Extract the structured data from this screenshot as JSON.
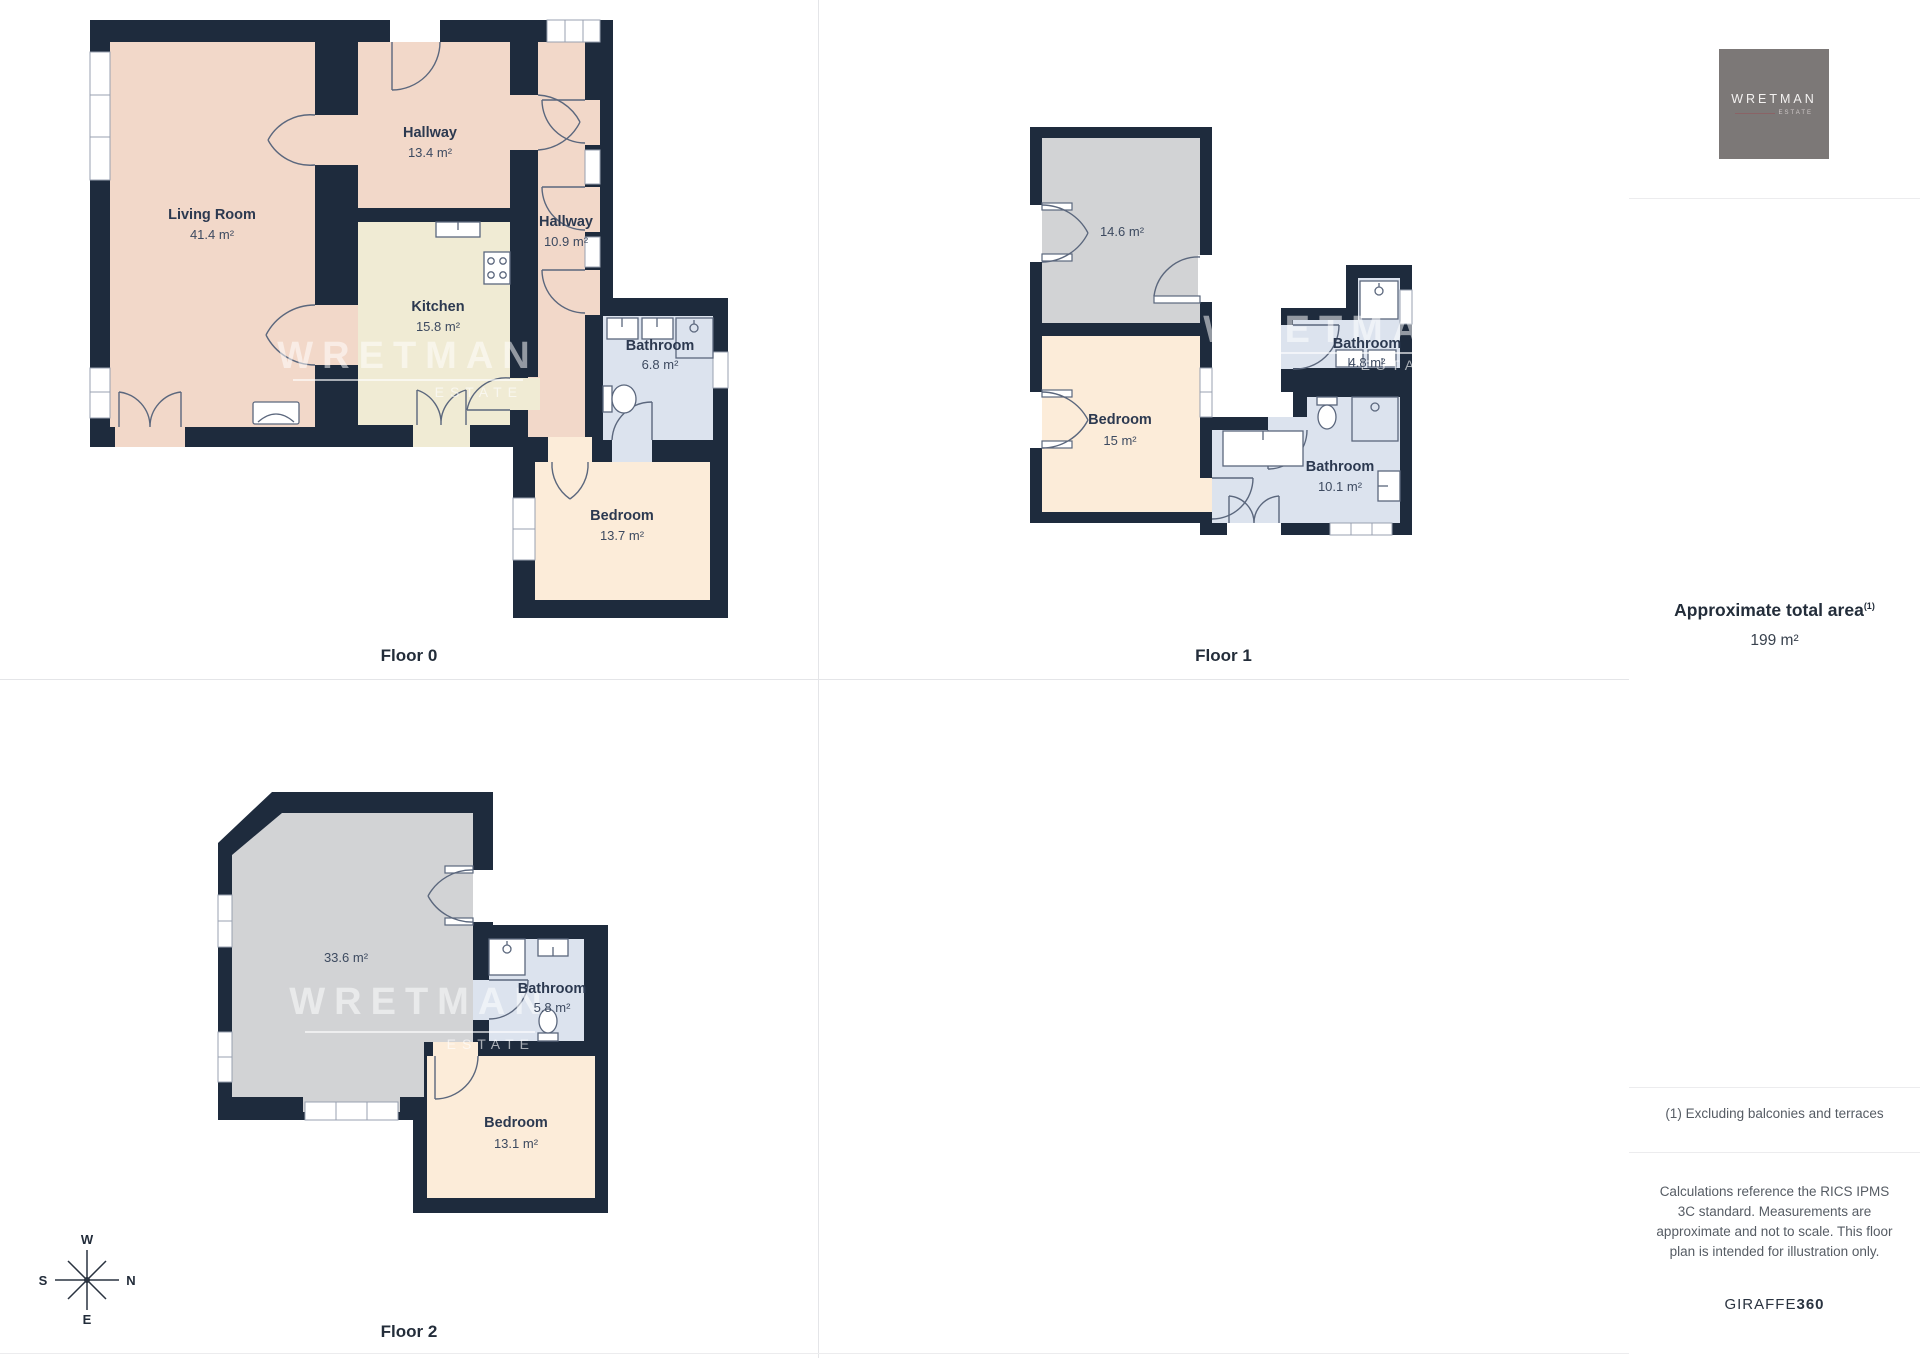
{
  "floors": [
    {
      "label": "Floor 0",
      "rooms": [
        {
          "name": "Living Room",
          "area": "41.4 m²"
        },
        {
          "name": "Hallway",
          "area": "13.4 m²"
        },
        {
          "name": "Kitchen",
          "area": "15.8 m²"
        },
        {
          "name": "Hallway",
          "area": "10.9 m²"
        },
        {
          "name": "Bathroom",
          "area": "6.8 m²"
        },
        {
          "name": "Bedroom",
          "area": "13.7 m²"
        }
      ]
    },
    {
      "label": "Floor 1",
      "rooms": [
        {
          "name": "",
          "area": "14.6 m²"
        },
        {
          "name": "Bedroom",
          "area": "15 m²"
        },
        {
          "name": "Bathroom",
          "area": "4.8 m²"
        },
        {
          "name": "Bathroom",
          "area": "10.1 m²"
        }
      ]
    },
    {
      "label": "Floor 2",
      "rooms": [
        {
          "name": "",
          "area": "33.6 m²"
        },
        {
          "name": "Bathroom",
          "area": "5.8 m²"
        },
        {
          "name": "Bedroom",
          "area": "13.1 m²"
        }
      ]
    }
  ],
  "compass": {
    "n": "N",
    "e": "E",
    "s": "S",
    "w": "W"
  },
  "watermark": {
    "brand": "WRETMAN",
    "sub": "ESTATE"
  },
  "sidebar": {
    "logo": {
      "brand": "WRETMAN",
      "sub": "ESTATE"
    },
    "total_area": {
      "label": "Approximate total area",
      "sup": "(1)",
      "value": "199 m²"
    },
    "footnote": "(1) Excluding balconies and terraces",
    "disclaimer": "Calculations reference the RICS IPMS 3C standard. Measurements are approximate and not to scale. This floor plan is intended for illustration only.",
    "credit": {
      "name": "GIRAFFE",
      "suffix": "360"
    }
  },
  "colors": {
    "wall": "#1e2b3d",
    "floor_pink": "#f2d8c9",
    "floor_cream": "#f0ebd4",
    "floor_blue": "#dce3ee",
    "floor_peach": "#fcecd9",
    "floor_gray": "#d2d3d5",
    "text": "#2c3950",
    "grid": "#e4e5e8",
    "logo_bg": "#7c7877"
  }
}
